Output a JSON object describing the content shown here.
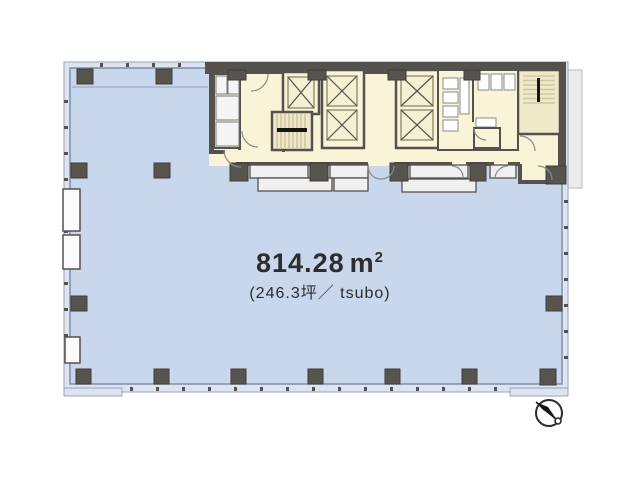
{
  "labels": {
    "area_value": "814.28",
    "area_unit": "m",
    "area_unit_sup": "2",
    "area_tsubo": "(246.3坪／ tsubo)"
  },
  "icons": {
    "compass": "north-arrow-icon"
  },
  "colors": {
    "office_fill": "#c9d7ec",
    "facade_band": "#dce4f1",
    "outline": "#97a3b4",
    "core_fill": "#f9f4d8",
    "wall": "#55514d",
    "column": "#57534f",
    "unit_fill": "#f0f0f0",
    "fixture_stroke": "#8a8a8a",
    "stair_stripe": "#cfc7a4",
    "elevator_stroke": "#9a9478",
    "door_stroke": "#8b8b8b",
    "text": "#2d2d2d"
  }
}
